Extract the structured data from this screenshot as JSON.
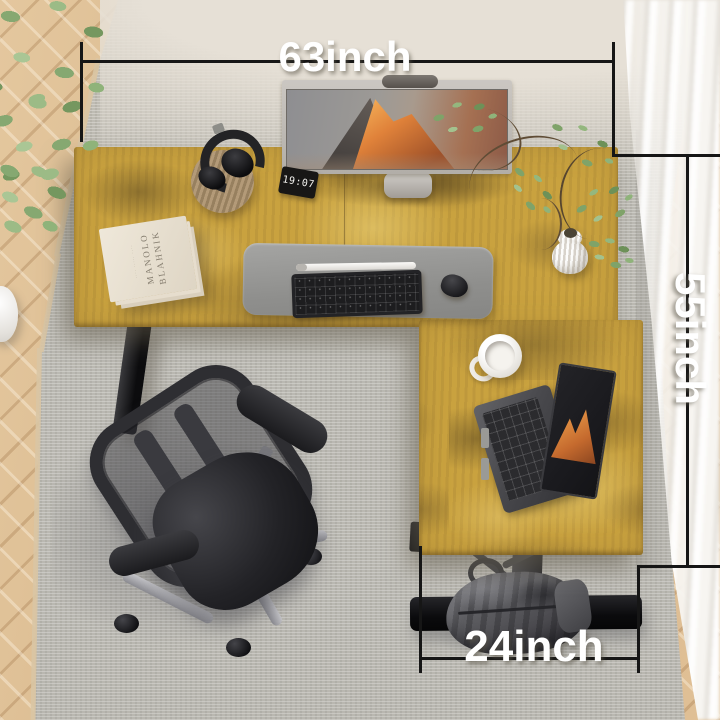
{
  "annotations": {
    "width_label": "63inch",
    "depth_label": "55inch",
    "return_width_label": "24inch",
    "line_color": "#161616",
    "label_text_color": "#ffffff"
  },
  "desk_clock": {
    "time": "19:07"
  },
  "book": {
    "title_line1": "MANOLO",
    "title_line2": "BLAHNIK"
  },
  "scene_objects": [
    "l-shaped-rustic-desk",
    "widescreen-monitor-with-mountain-wallpaper",
    "laptop-with-mountain-wallpaper",
    "black-keyboard",
    "white-stylus-pen",
    "black-mouse",
    "gray-desk-mat",
    "headphones-on-round-mat",
    "digital-clock",
    "book-stack",
    "white-coffee-mug",
    "ribbed-white-vase-with-branches",
    "black-mesh-office-chair",
    "gray-duffel-bag-on-desk-foot",
    "indoor-plant",
    "white-floor-vase",
    "gray-area-rug",
    "herringbone-wood-floor",
    "white-curtain"
  ],
  "colors": {
    "desk_gold": "#c9a23f",
    "rug_gray": "#dbdad6",
    "wood_floor": "#dcbe95",
    "chair_black": "#232327",
    "mat_gray": "#95948f",
    "curtain_white": "#f7f5f1"
  }
}
